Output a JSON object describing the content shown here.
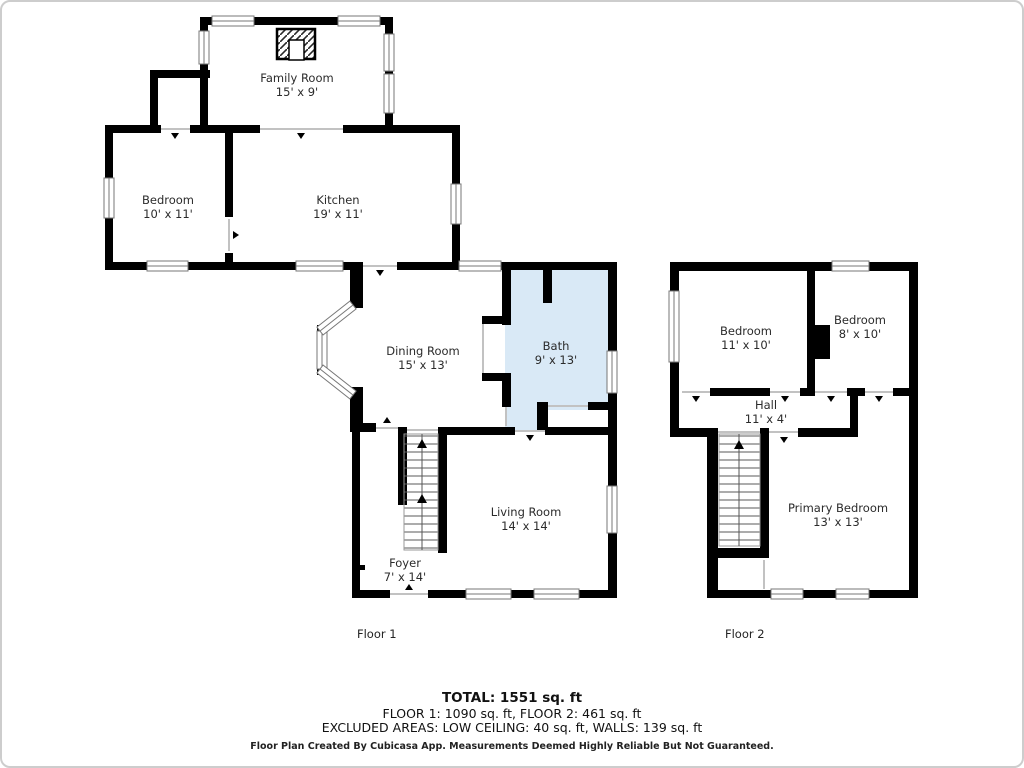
{
  "floor1": {
    "label": "Floor 1",
    "rooms": [
      {
        "name": "Family Room",
        "dims": "15' x 9'"
      },
      {
        "name": "Bedroom",
        "dims": "10' x 11'"
      },
      {
        "name": "Kitchen",
        "dims": "19' x 11'"
      },
      {
        "name": "Dining Room",
        "dims": "15' x 13'"
      },
      {
        "name": "Bath",
        "dims": "9' x 13'"
      },
      {
        "name": "Living Room",
        "dims": "14' x 14'"
      },
      {
        "name": "Foyer",
        "dims": "7' x 14'"
      }
    ]
  },
  "floor2": {
    "label": "Floor 2",
    "rooms": [
      {
        "name": "Bedroom",
        "dims": "11' x 10'"
      },
      {
        "name": "Bedroom",
        "dims": "8' x 10'"
      },
      {
        "name": "Hall",
        "dims": "11' x 4'"
      },
      {
        "name": "Primary Bedroom",
        "dims": "13' x 13'"
      }
    ]
  },
  "summary": {
    "total": "TOTAL: 1551 sq. ft",
    "floors": "FLOOR 1: 1090 sq. ft, FLOOR 2: 461 sq. ft",
    "excluded": "EXCLUDED AREAS: LOW CEILING: 40 sq. ft, WALLS: 139 sq. ft",
    "disclaimer": "Floor Plan Created By Cubicasa App. Measurements Deemed Highly Reliable But Not Guaranteed."
  },
  "colors": {
    "wall": "#000000",
    "bath_fill": "#d9e9f6",
    "window_line": "#777777",
    "door_line": "#c2c2c2"
  }
}
